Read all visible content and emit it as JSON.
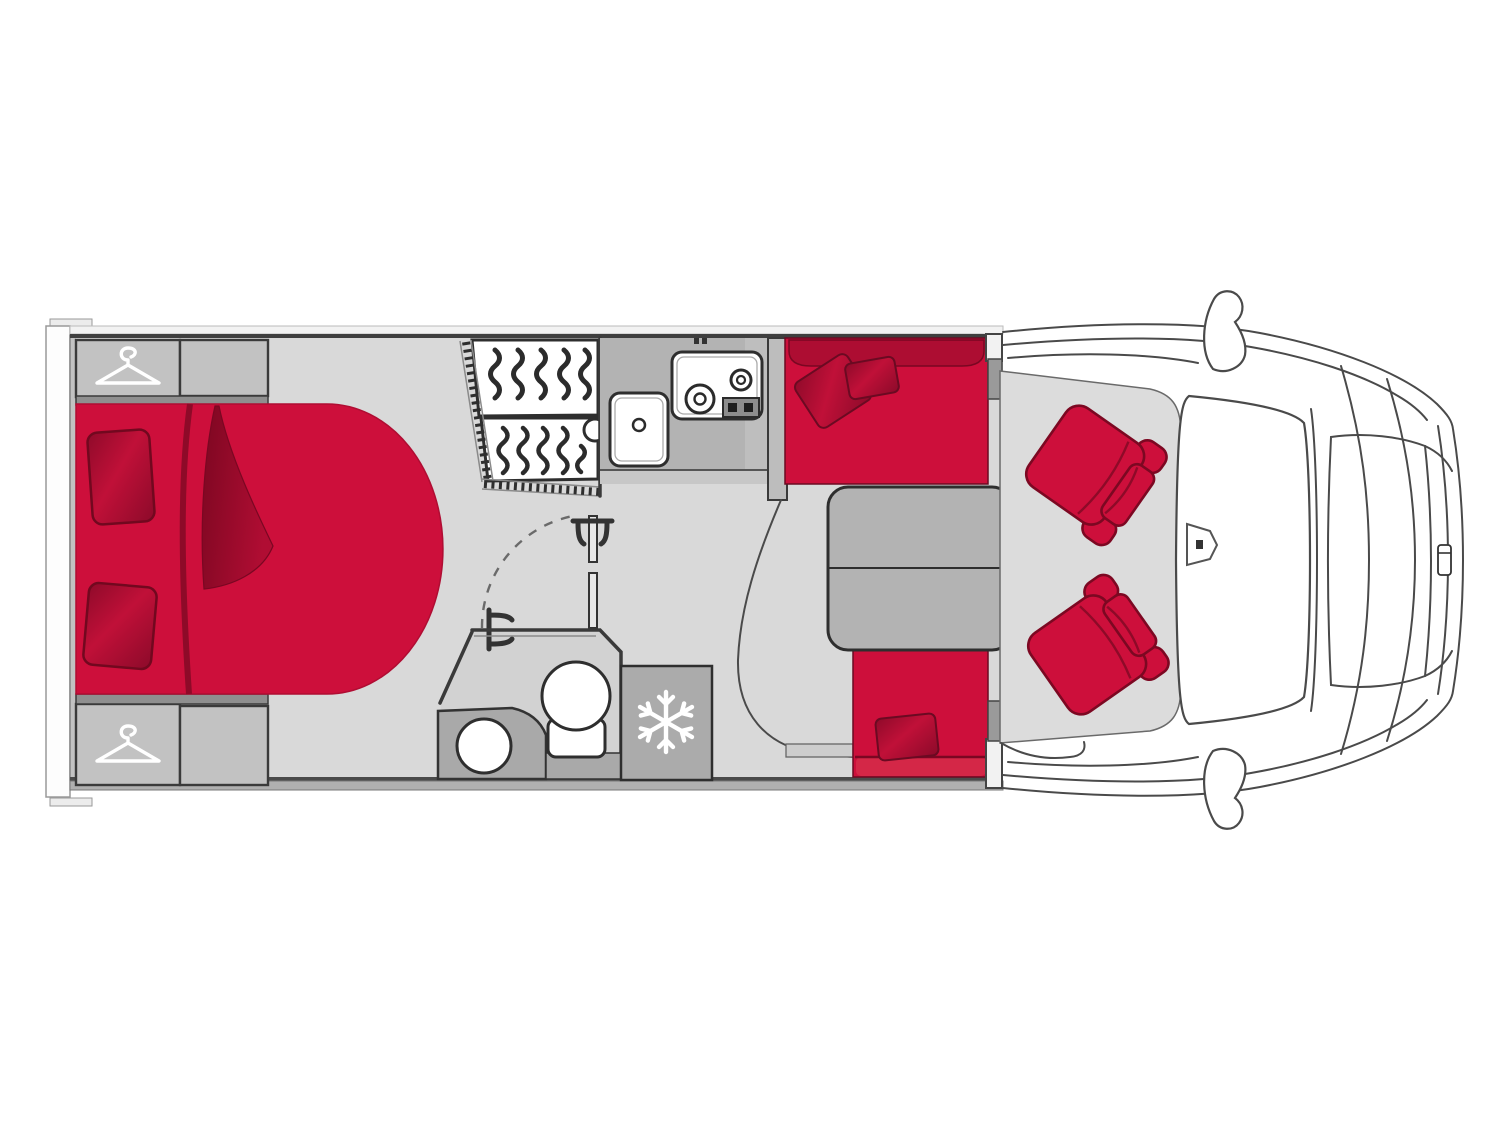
{
  "diagram": {
    "kind": "motorhome-floorplan-top-view",
    "areas": [
      "rear-wardrobe-top",
      "rear-wardrobe-bottom",
      "island-bed",
      "shower",
      "bathroom",
      "washbasin",
      "toilet",
      "kitchen-counter",
      "kitchen-sink",
      "hob",
      "fridge",
      "dinette-bench-front",
      "dinette-bench-rear",
      "dinette-table",
      "cab-seat-left",
      "cab-seat-right",
      "cab-floor",
      "vehicle-front"
    ],
    "icons": {
      "wardrobe": "hanger-icon",
      "fridge": "snowflake-icon"
    }
  },
  "colors": {
    "background": "#ffffff",
    "floor": "#d9d9d9",
    "cab_floor": "#dcdcdc",
    "cabinet": "#c2c2c2",
    "cabinet_dark": "#8f8f8f",
    "counter": "#b3b3b3",
    "counter_edge": "#c7c7c7",
    "counter_band": "#bebebe",
    "pillar": "#bdbdbd",
    "fridge": "#ababab",
    "vanity": "#a9a9a9",
    "pedestal": "#d2d2d2",
    "table": "#b3b3b3",
    "wall_band": "#b0b0b0",
    "wall_white": "#f2f2f2",
    "step": "#cdcdcd",
    "red": "#cd0f3b",
    "red_mid": "#ad0d32",
    "red_dark": "#990b2d",
    "red_deep": "#7a0722",
    "red_front": "#d42747",
    "outline": "#2e2e2e",
    "vehicle_line": "#4a4a4a",
    "white": "#ffffff"
  }
}
